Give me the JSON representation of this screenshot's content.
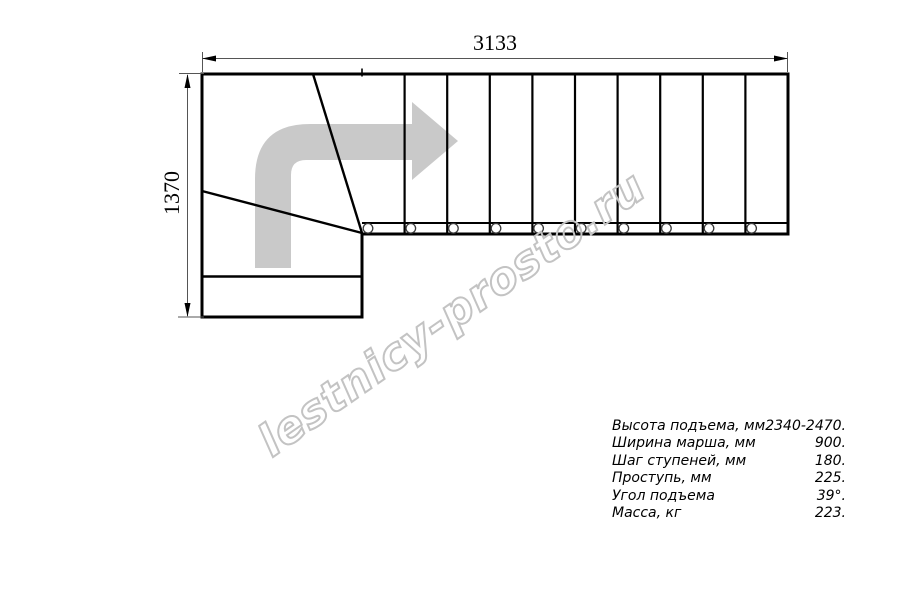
{
  "drawing": {
    "top_dimension_mm": "3133",
    "left_dimension_mm": "1370"
  },
  "specs": {
    "rows": [
      {
        "label": "Высота подъема, мм",
        "value": "2340-2470."
      },
      {
        "label": "Ширина марша, мм",
        "value": "900."
      },
      {
        "label": "Шаг ступеней, мм",
        "value": "180."
      },
      {
        "label": "Проступь, мм",
        "value": "225."
      },
      {
        "label": "Угол подъема",
        "value": "39°."
      },
      {
        "label": "Масса, кг",
        "value": "223."
      }
    ]
  },
  "watermark": {
    "text": "lestnicy-prosto.ru"
  },
  "colors": {
    "line": "#000000",
    "dim": "#555555",
    "arrow": "#c9c9c9",
    "watermark_outline": "#c3c3c3"
  }
}
